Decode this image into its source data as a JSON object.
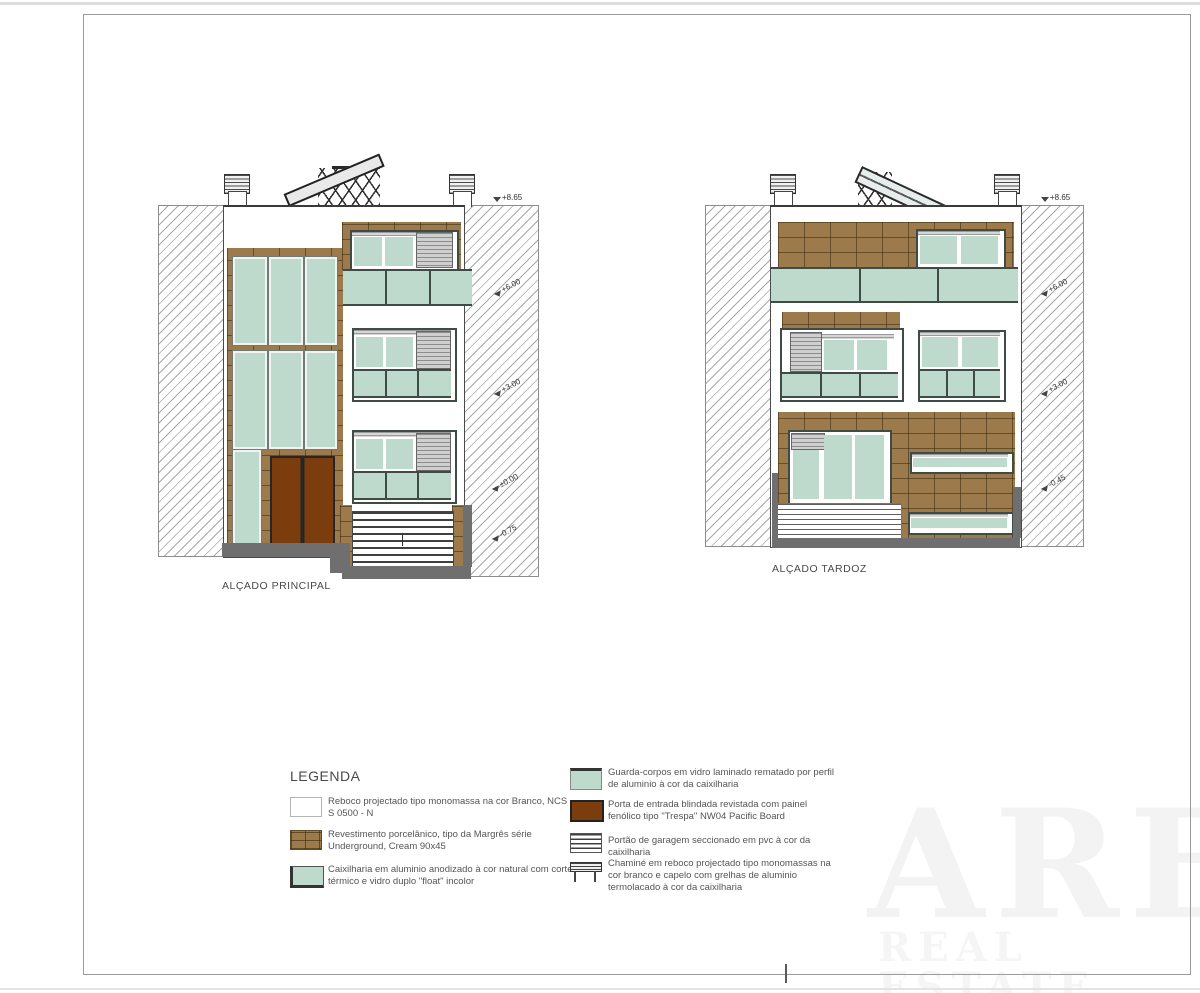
{
  "watermark": {
    "line1": "ARE",
    "line2": "REAL ESTATE"
  },
  "elevations": {
    "principal": {
      "label": "ALÇADO PRINCIPAL",
      "markers": [
        {
          "value": "+8.65"
        },
        {
          "value": "+6.00"
        },
        {
          "value": "+3.00"
        },
        {
          "value": "±0.00"
        },
        {
          "value": "-0.75"
        }
      ]
    },
    "tardoz": {
      "label": "ALÇADO TARDOZ",
      "markers": [
        {
          "value": "+8.65"
        },
        {
          "value": "+6.00"
        },
        {
          "value": "+3.00"
        },
        {
          "value": "-0.45"
        }
      ]
    }
  },
  "legend": {
    "title": "LEGENDA",
    "left_items": [
      {
        "swatch": "render-white",
        "text": "Reboco projectado tipo monomassa na cor Branco, NCS S 0500 - N"
      },
      {
        "swatch": "tile-brown",
        "text": "Revestimento porcelânico, tipo da Margrês série Underground, Cream 90x45"
      },
      {
        "swatch": "glass-teal",
        "text": "Caixilharia em aluminio anodizado à cor natural com corte térmico e vidro duplo \"float\" incolor"
      }
    ],
    "right_items": [
      {
        "swatch": "glass-rail",
        "text": "Guarda-corpos em vidro laminado rematado por perfil de aluminio à cor da caixilharia"
      },
      {
        "swatch": "door-brown",
        "text": "Porta de entrada blindada revistada com painel fenólico tipo \"Trespa\" NW04 Pacific Board"
      },
      {
        "swatch": "garage-stripes",
        "text": "Portão de garagem seccionado em pvc à cor da caixilharia"
      },
      {
        "swatch": "chimney",
        "text": "Chaminé em reboco projectado tipo monomassas na cor branco e capelo com grelhas de aluminio termolacado à cor da caixilharia"
      }
    ]
  },
  "colors": {
    "tile": "#9c7a4b",
    "glass": "#bedacd",
    "door": "#7b3c0e",
    "base_gray": "#6f6f6f"
  }
}
